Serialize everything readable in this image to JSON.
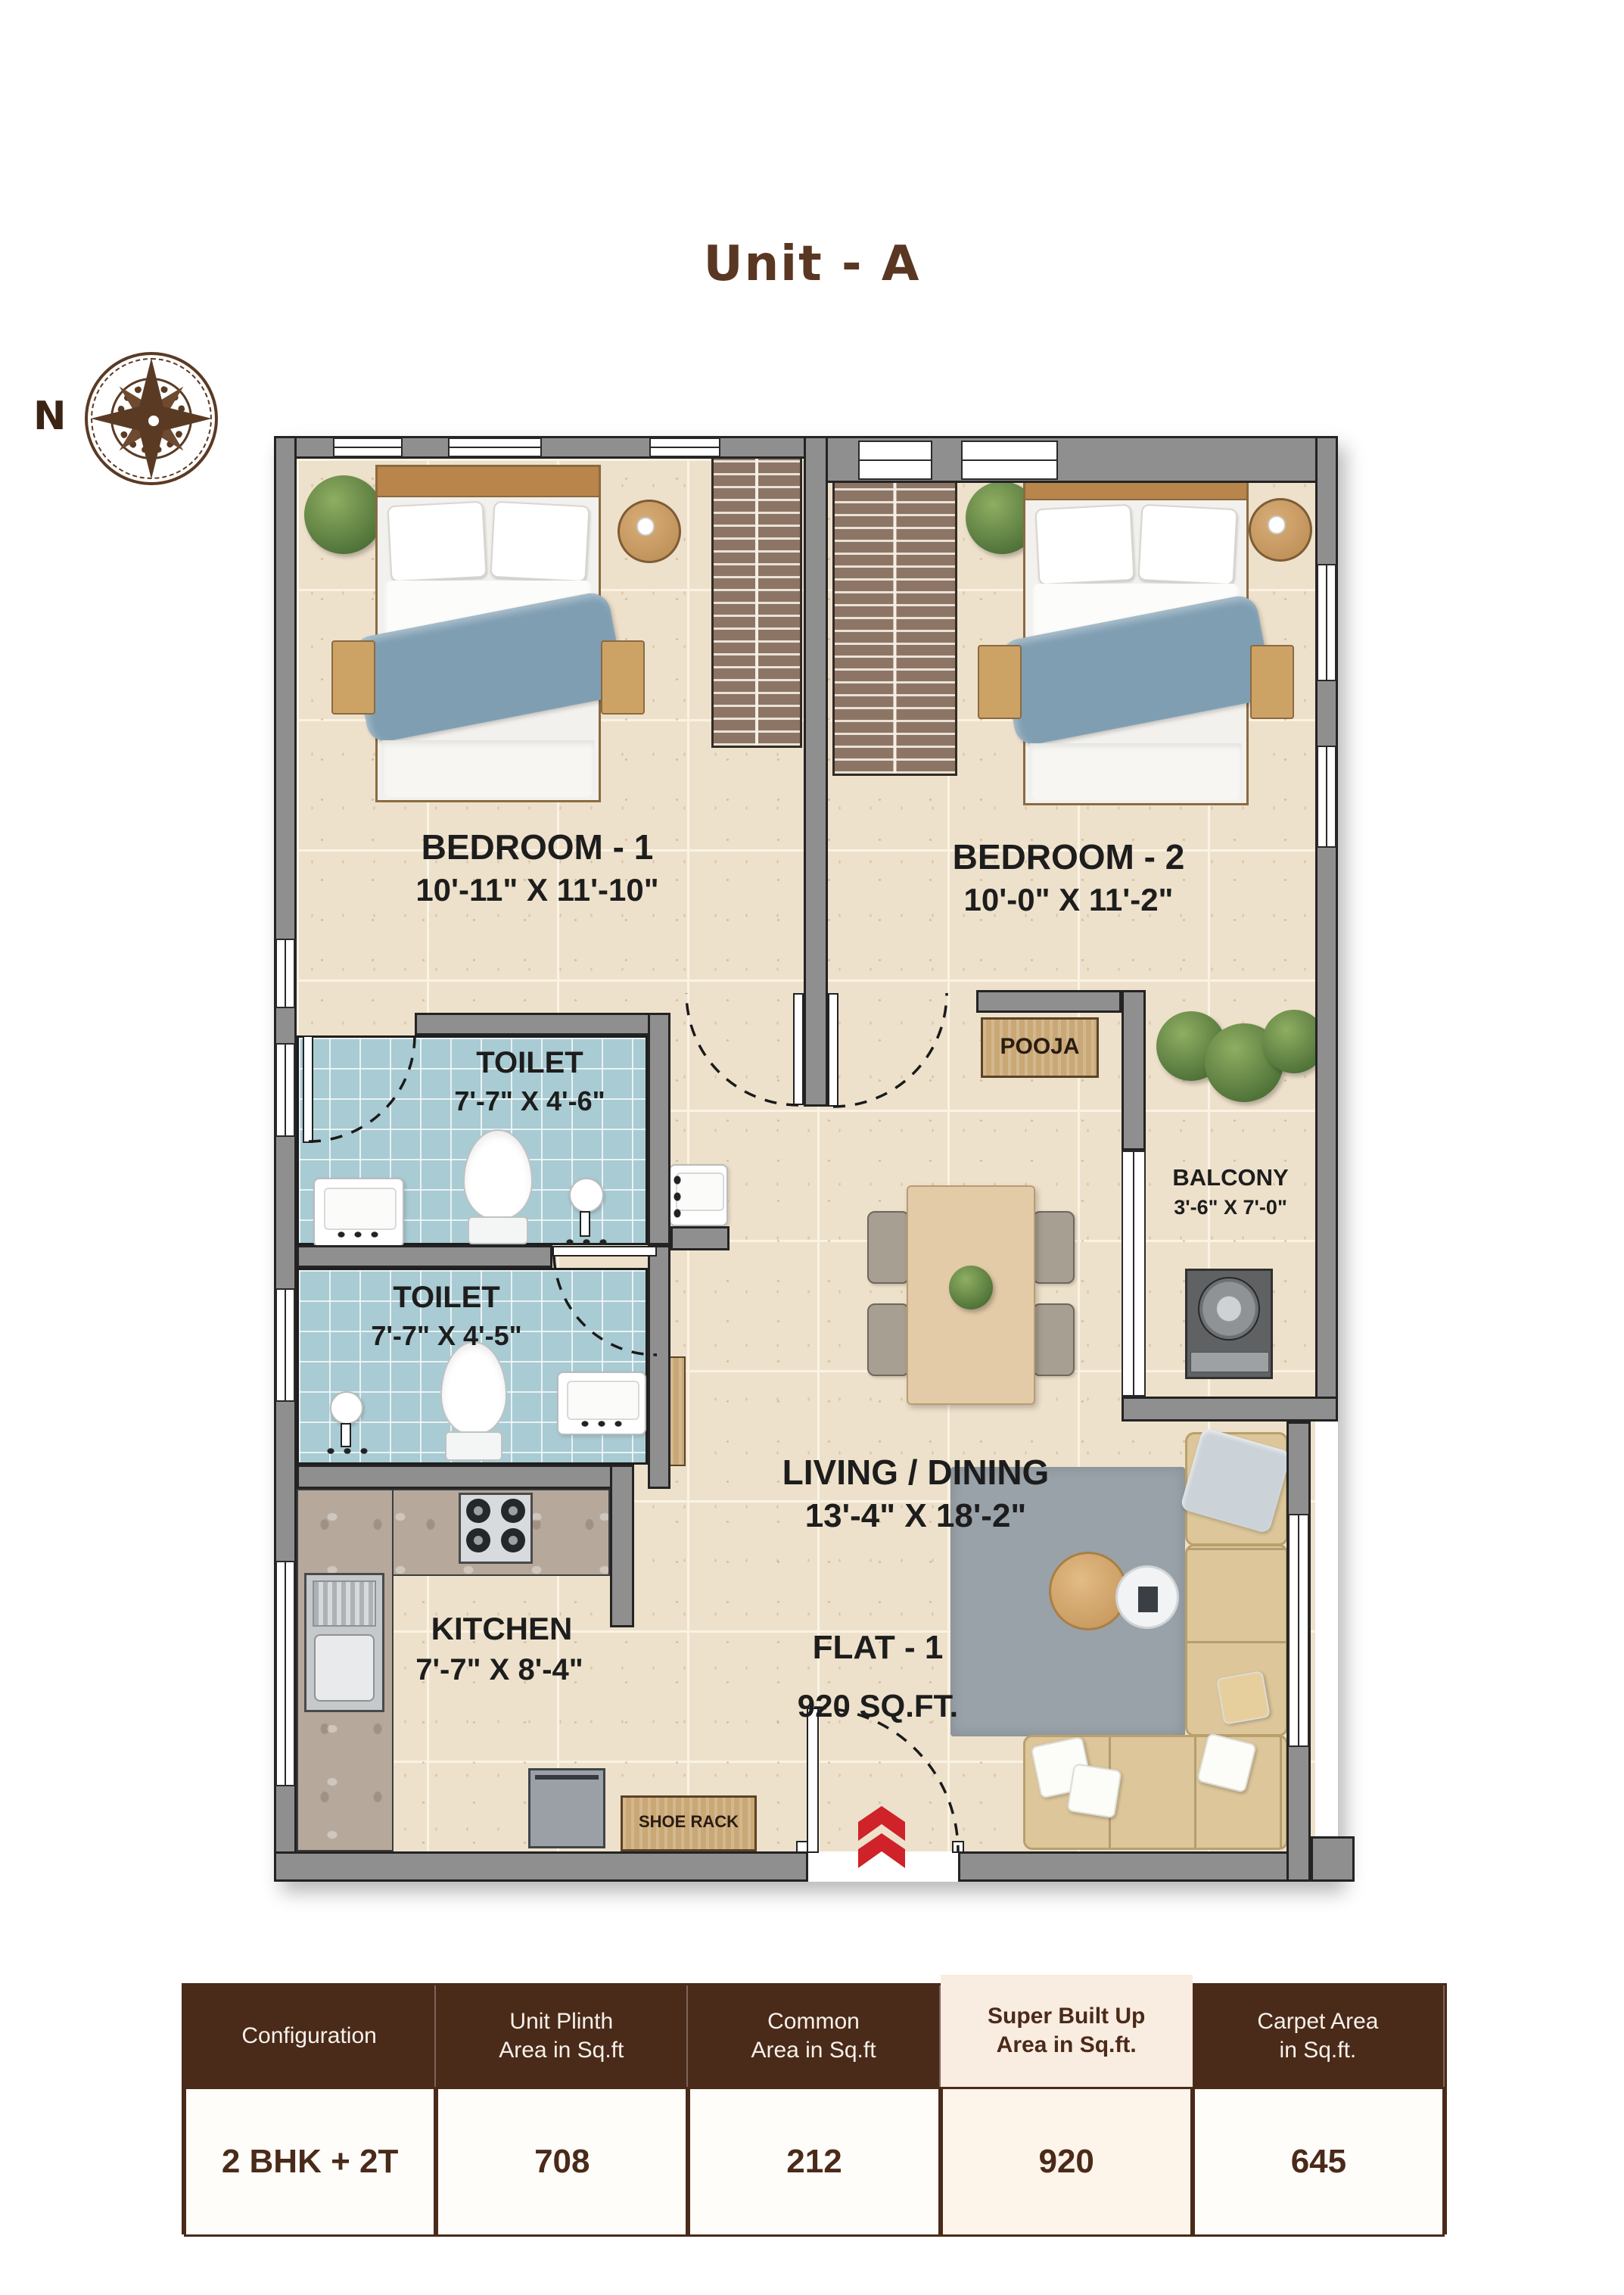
{
  "title": "Unit - A",
  "compass": {
    "north_label": "N"
  },
  "plan": {
    "bedroom1": {
      "name": "BEDROOM - 1",
      "dims": "10'-11\" X 11'-10\""
    },
    "bedroom2": {
      "name": "BEDROOM - 2",
      "dims": "10'-0\" X 11'-2\""
    },
    "toilet1": {
      "name": "TOILET",
      "dims": "7'-7\" X 4'-6\""
    },
    "toilet2": {
      "name": "TOILET",
      "dims": "7'-7\" X 4'-5\""
    },
    "kitchen": {
      "name": "KITCHEN",
      "dims": "7'-7\" X 8'-4\""
    },
    "living": {
      "name": "LIVING / DINING",
      "dims": "13'-4\" X 18'-2\""
    },
    "balcony": {
      "name": "BALCONY",
      "dims": "3'-6\" X 7'-0\""
    },
    "pooja_label": "POOJA",
    "shoe_rack_label": "SHOE RACK",
    "flat_label": "FLAT - 1",
    "flat_area": "920 SQ.FT."
  },
  "summary_table": {
    "headers": [
      "Configuration",
      "Unit Plinth\nArea in Sq.ft",
      "Common\nArea in Sq.ft",
      "Super Built Up\nArea in Sq.ft.",
      "Carpet Area\nin Sq.ft."
    ],
    "row": {
      "configuration": "2 BHK + 2T",
      "unit_plinth": "708",
      "common": "212",
      "super_built_up": "920",
      "carpet": "645"
    }
  },
  "colors": {
    "accent_brown": "#5a3722",
    "table_header_bg": "#4a2a19",
    "highlight_bg": "#f9ece1",
    "wall_gray": "#8f8f8f",
    "floor_beige": "#eee1cb",
    "toilet_floor_blue": "#a9cbd3",
    "arrow_red": "#cf2229"
  }
}
